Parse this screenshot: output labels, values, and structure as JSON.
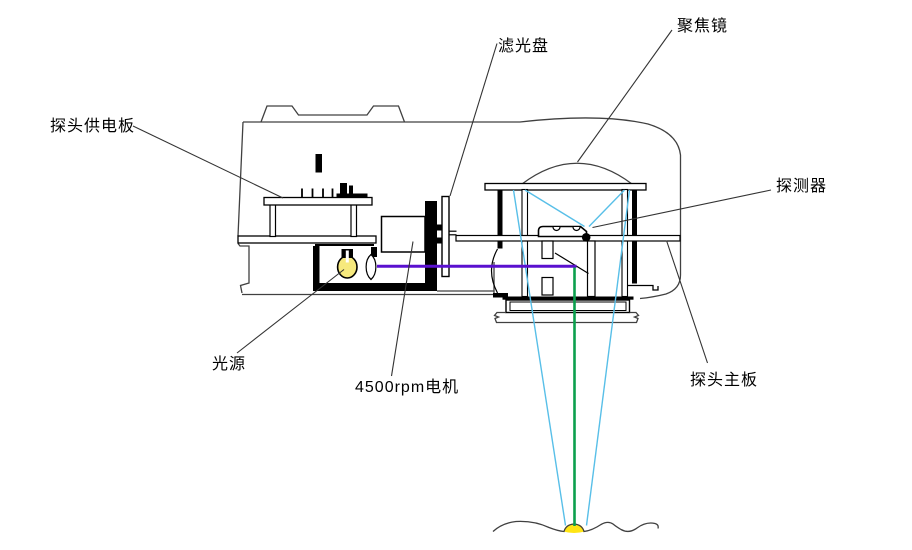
{
  "diagram": {
    "title": "光学探头内部结构示意图",
    "labels": {
      "power_board": "探头供电板",
      "filter_disk": "滤光盘",
      "focus_lens": "聚焦镜",
      "detector": "探测器",
      "light_source": "光源",
      "motor": "4500rpm电机",
      "main_board": "探头主板"
    },
    "colors": {
      "beam_purple": "#5a10cf",
      "beam_green": "#0b9f4d",
      "ray_cyan": "#58bfe8",
      "bulb_yellow": "#f6e97d",
      "spot_yellow": "#ffe515",
      "outline_gray": "#404040",
      "component_black": "#000000"
    }
  }
}
